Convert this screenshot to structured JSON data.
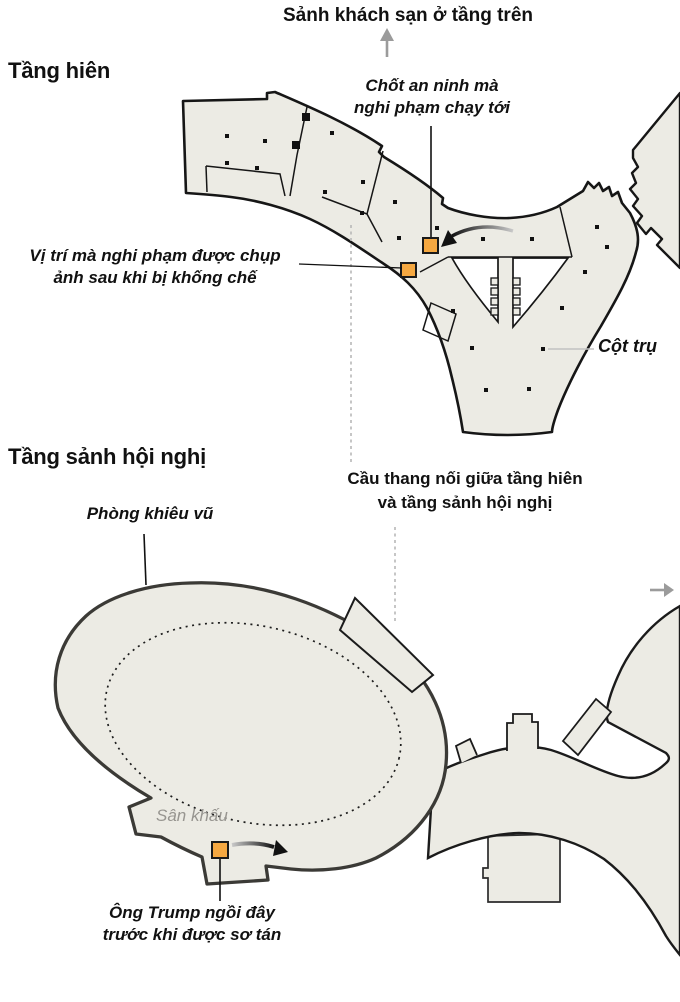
{
  "figure": {
    "upper_floor": {
      "title": "Tầng hiên",
      "direction_note": "Sảnh khách sạn ở tầng trên",
      "security_label_line1": "Chốt an ninh mà",
      "security_label_line2": "nghi phạm chạy tới",
      "photo_label_line1": "Vị trí mà nghi phạm được chụp",
      "photo_label_line2": "ảnh sau khi bị khống chế",
      "pillar_label": "Cột trụ"
    },
    "lower_floor": {
      "title": "Tầng sảnh hội nghị",
      "stairs_label_line1": "Cầu thang nối giữa tầng hiên",
      "stairs_label_line2": "và tầng sảnh hội nghị",
      "ballroom_label": "Phòng khiêu vũ",
      "stage_label": "Sân khấu",
      "trump_label_line1": "Ông Trump ngồi đây",
      "trump_label_line2": "trước khi được sơ tán"
    }
  },
  "palette": {
    "plan_fill": "#ECEBE4",
    "plan_stroke": "#161616",
    "ellipse_stroke": "#3B3A36",
    "marker_orange": "#F5A841",
    "marker_border": "#1A1A1A",
    "connector_gray": "#B8B8B8",
    "arrow_gray": "#9B9B9B",
    "stage_text_gray": "#979590"
  }
}
